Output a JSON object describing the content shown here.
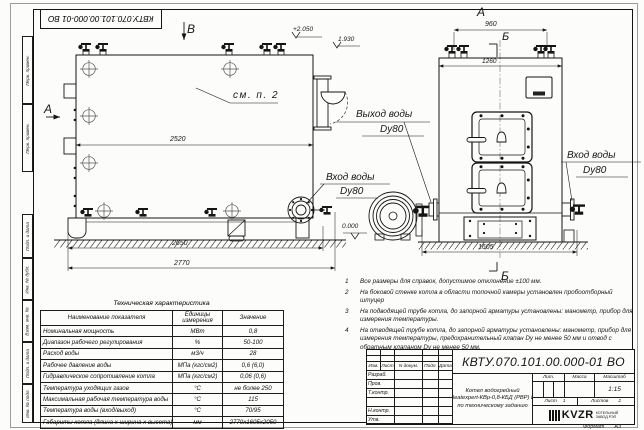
{
  "stamp": {
    "doc_number_top": "КВТУ.070.101.00.000-01  ВО"
  },
  "frame": {
    "col_top_1": "Перв. примен.",
    "col_top_2": "Перв. примен.",
    "col_1": "Подп. и дата",
    "col_2": "Инв. № дубл.",
    "col_3": "Взам. инв. №",
    "col_4": "Подп. и дата",
    "col_5": "Инв. № подл.",
    "format_label": "Формат",
    "format_value": "А3"
  },
  "drawing": {
    "views": {
      "v_top": "В",
      "a_left": "А",
      "a_top": "А",
      "b_top": "Б",
      "b_bottom": "Б"
    },
    "dims": {
      "d2520": "2520",
      "d2650": "2650",
      "d2770": "2770",
      "d960": "960",
      "d1260": "1260",
      "d1605": "1605"
    },
    "elevations": {
      "e1": "+2.050",
      "e2": "1.930",
      "e3": "0.000"
    },
    "callouts": {
      "see": "см. п. 2",
      "out_t": "Выход воды",
      "out_d": "Dy80",
      "in_left_t": "Вход воды",
      "in_left_d": "Dy80",
      "in_right_t": "Вход воды",
      "in_right_d": "Dy80"
    }
  },
  "spec_table": {
    "title": "Техническая характеристика",
    "headers": [
      "Наименование показателя",
      "Единицы измерения",
      "Значение"
    ],
    "rows": [
      [
        "Номинальная мощность",
        "МВт",
        "0,8"
      ],
      [
        "Диапазон рабочего регулирования",
        "%",
        "50-100"
      ],
      [
        "Расход воды",
        "м3/ч",
        "28"
      ],
      [
        "Рабочее давление воды",
        "МПа (кгс/см2)",
        "0,6 (6,0)"
      ],
      [
        "Гидравлическое сопротивление котла",
        "МПа (кгс/см2)",
        "0,06 (0,6)"
      ],
      [
        "Температура уходящих газов",
        "°С",
        "не более 250"
      ],
      [
        "Максимальная рабочая температура воды",
        "°С",
        "115"
      ],
      [
        "Температура воды (вход/выход)",
        "°С",
        "70/95"
      ],
      [
        "Габариты котла (длина х ширина х высота)",
        "мм",
        "2770х1605х2050"
      ]
    ]
  },
  "notes": [
    {
      "n": "1",
      "text": "Все размеры для справок, допустимое отклонение ±100 мм."
    },
    {
      "n": "2",
      "text": "На боковой стенке котла в области топочной камеры установлен пробоотборный штуцер"
    },
    {
      "n": "3",
      "text": "На подводящей трубе котла, до запорной арматуры установлены: манометр, прибор для измерения температуры."
    },
    {
      "n": "4",
      "text": "На отводящей трубе котла, до запорной арматуры установлены: манометр, прибор для измерения температуры, предохранительный клапан Dу не менее 50 мм и отвод с обратным клапаном Dу не менее 50 мм."
    }
  ],
  "title_block": {
    "doc_number": "КВТУ.070.101.00.000-01  ВО",
    "name_line1": "Котел водогрейный",
    "name_line2": "Heatexpert-КВр-0,8-КБД (РВР) И",
    "name_line3": "по техническому заданию",
    "hdr_izm": "Изм.",
    "hdr_list": "Лист",
    "hdr_doc": "N докум.",
    "hdr_podp": "Подп.",
    "hdr_data": "Дата",
    "row_razrab": "Разраб.",
    "row_prov": "Пров.",
    "row_tkontr": "Т.контр.",
    "row_nkontr": "Н.контр.",
    "row_utv": "Утв.",
    "lit_label": "Лит.",
    "massa_label": "Масса",
    "scale_label": "Масштаб",
    "scale_value": "1:15",
    "sheet_label": "Лист",
    "sheet_value": "1",
    "sheets_label": "Листов",
    "sheets_value": "2",
    "logo_text": "KVZR",
    "logo_sub1": "КОТЕЛЬНЫЙ",
    "logo_sub2": "ЗАВОД РЭП"
  }
}
